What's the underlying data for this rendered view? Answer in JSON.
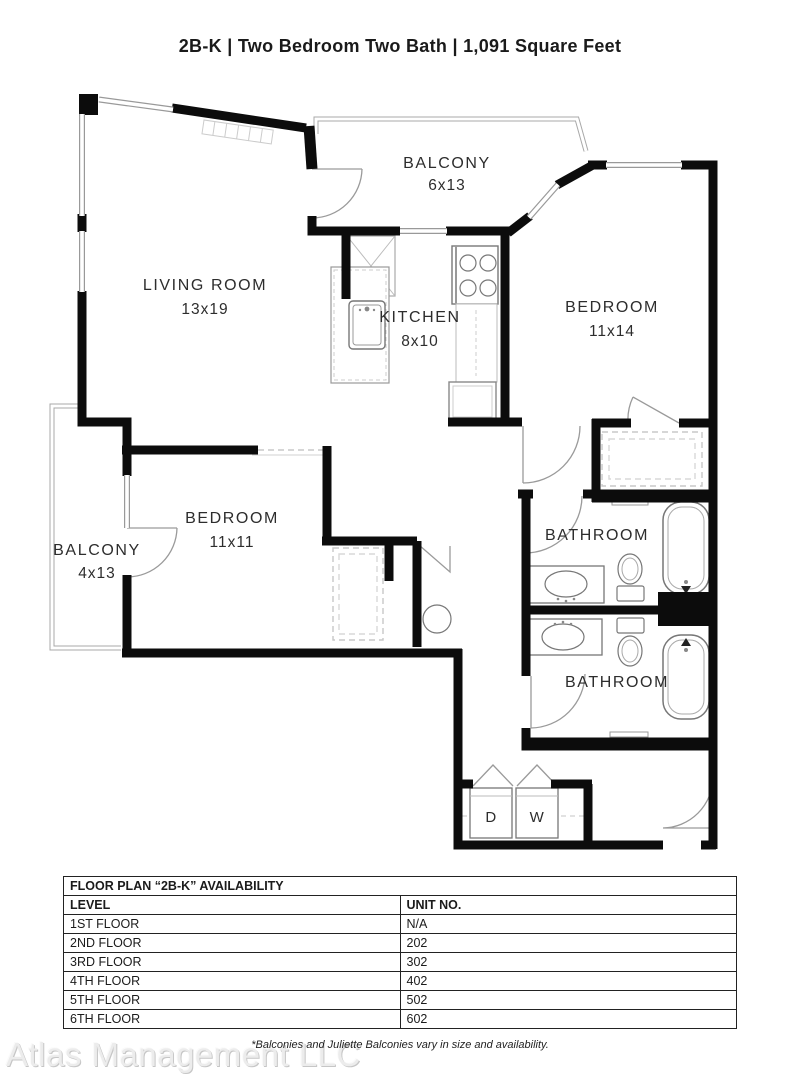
{
  "title": "2B-K | Two Bedroom Two Bath | 1,091 Square Feet",
  "floor_plan": {
    "rooms": [
      {
        "name": "BALCONY",
        "dims": "6x13"
      },
      {
        "name": "LIVING ROOM",
        "dims": "13x19"
      },
      {
        "name": "KITCHEN",
        "dims": "8x10"
      },
      {
        "name": "BEDROOM",
        "dims": "11x14"
      },
      {
        "name": "BEDROOM",
        "dims": "11x11"
      },
      {
        "name": "BALCONY",
        "dims": "4x13"
      },
      {
        "name": "BATHROOM"
      },
      {
        "name": "BATHROOM"
      }
    ],
    "appliances": {
      "dryer": "D",
      "washer": "W"
    },
    "colors": {
      "wall": "#0c0c0c",
      "thin_line": "#999999",
      "dash_line": "#c8c8c8"
    }
  },
  "availability_table": {
    "title": "FLOOR PLAN “2B-K” AVAILABILITY",
    "columns": [
      "LEVEL",
      "UNIT NO."
    ],
    "rows": [
      [
        "1ST FLOOR",
        "N/A"
      ],
      [
        "2ND FLOOR",
        "202"
      ],
      [
        "3RD FLOOR",
        "302"
      ],
      [
        "4TH FLOOR",
        "402"
      ],
      [
        "5TH FLOOR",
        "502"
      ],
      [
        "6TH FLOOR",
        "602"
      ]
    ]
  },
  "footer": {
    "watermark": "Atlas Management LLC",
    "note": "*Balconies and Juliette Balconies vary in size and availability."
  }
}
